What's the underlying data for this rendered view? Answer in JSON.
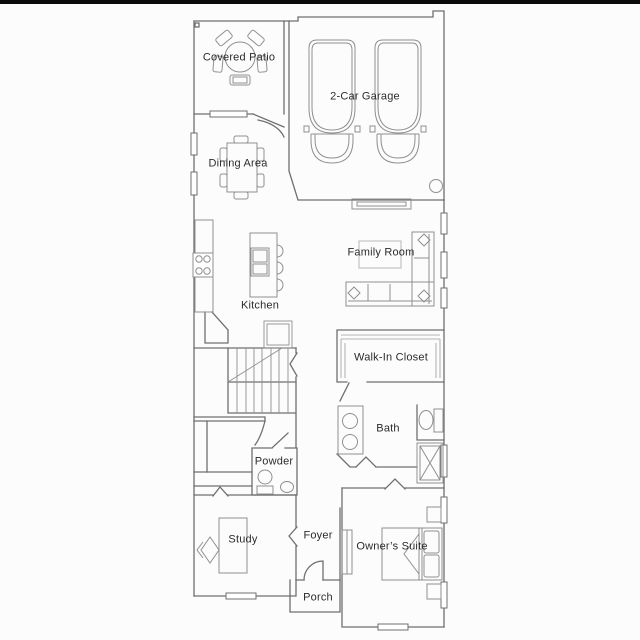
{
  "page": {
    "background_color": "#fcfcfc",
    "top_strip_color": "#0a0a0a"
  },
  "floorplan": {
    "wall_color": "#6f6f6f",
    "furniture_color": "#8f8f8f",
    "text_color": "#2b2b2b",
    "rooms": {
      "covered_patio": {
        "label": "Covered Patio"
      },
      "garage": {
        "label": "2-Car Garage"
      },
      "dining": {
        "label": "Dining Area"
      },
      "kitchen": {
        "label": "Kitchen"
      },
      "family_room": {
        "label": "Family Room"
      },
      "walk_in_closet": {
        "label": "Walk-In Closet"
      },
      "bath": {
        "label": "Bath"
      },
      "powder": {
        "label": "Powder"
      },
      "study": {
        "label": "Study"
      },
      "foyer": {
        "label": "Foyer"
      },
      "owners_suite": {
        "label": "Owner’s Suite"
      },
      "porch": {
        "label": "Porch"
      }
    }
  }
}
